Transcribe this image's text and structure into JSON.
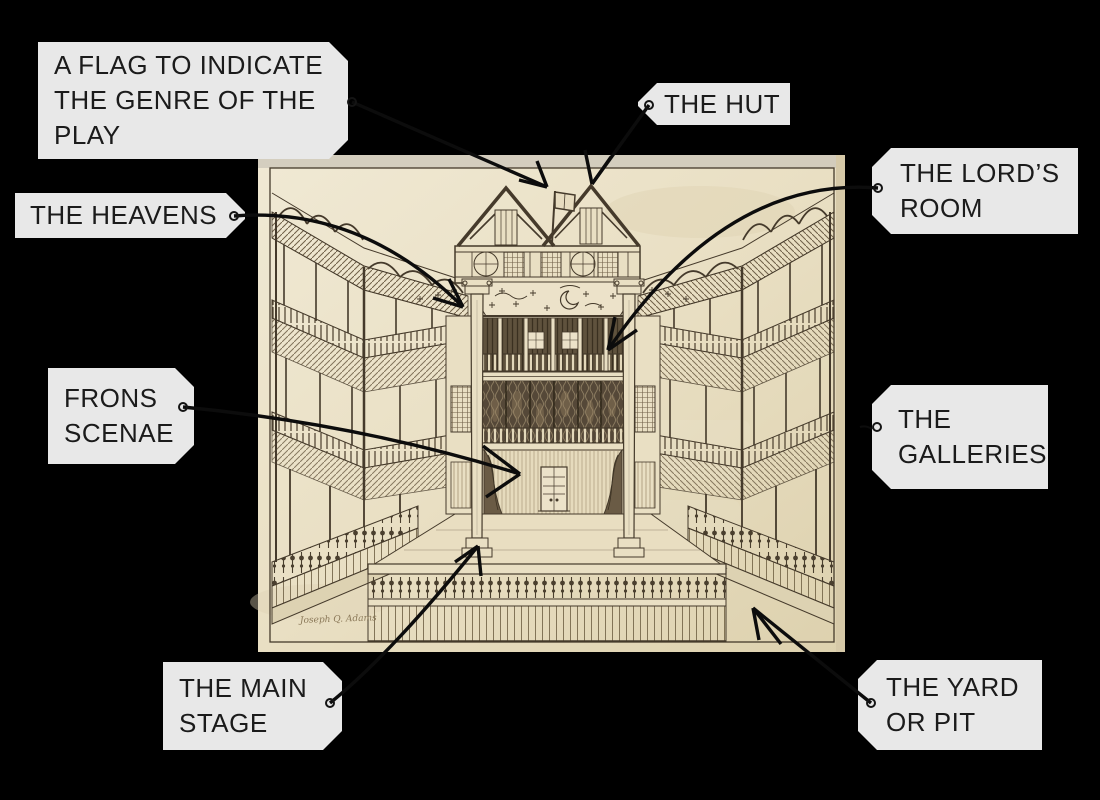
{
  "scene": {
    "background": "#000000"
  },
  "artwork": {
    "signature": "Joseph Q. Adams",
    "paper_color": "#e9dfc3",
    "ink_color": "#453a2b",
    "arrow_color": "#0c0c0c",
    "label_bg": "#e8e8e8",
    "label_text_color": "#1b1b1b"
  },
  "labels": [
    {
      "id": "flag-genre",
      "lines": [
        "A FLAG TO INDICATE",
        "THE GENRE OF THE",
        "PLAY"
      ]
    },
    {
      "id": "the-hut",
      "lines": [
        "THE HUT"
      ]
    },
    {
      "id": "lords-room",
      "lines": [
        "THE LORD’S",
        "ROOM"
      ]
    },
    {
      "id": "the-heavens",
      "lines": [
        "THE HEAVENS"
      ]
    },
    {
      "id": "frons-scenae",
      "lines": [
        "FRONS",
        "SCENAE"
      ]
    },
    {
      "id": "the-galleries",
      "lines": [
        "THE",
        "GALLERIES"
      ]
    },
    {
      "id": "main-stage",
      "lines": [
        "THE MAIN",
        "STAGE"
      ]
    },
    {
      "id": "yard-pit",
      "lines": [
        "THE YARD",
        "OR PIT"
      ]
    }
  ]
}
